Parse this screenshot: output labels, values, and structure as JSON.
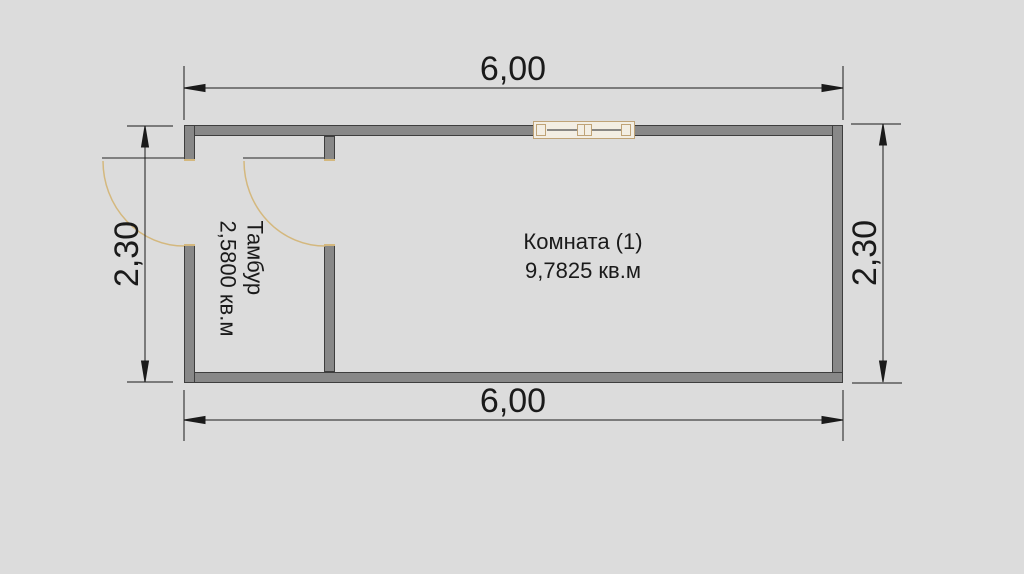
{
  "plan": {
    "rooms": [
      {
        "name": "Комната (1)",
        "area": "9,7825 кв.м"
      },
      {
        "name": "Тамбур",
        "area": "2,5800 кв.м"
      }
    ],
    "dimensions": {
      "top": "6,00",
      "bottom": "6,00",
      "left": "2,30",
      "right": "2,30"
    },
    "colors": {
      "background": "#dcdcdc",
      "wall_fill": "#888888",
      "wall_outline": "#3e3e3e",
      "dimension_ink": "#1a1a1a",
      "door_swing": "#d4b87e",
      "window_frame": "#bfa377",
      "window_fill": "#f3eee3"
    }
  }
}
